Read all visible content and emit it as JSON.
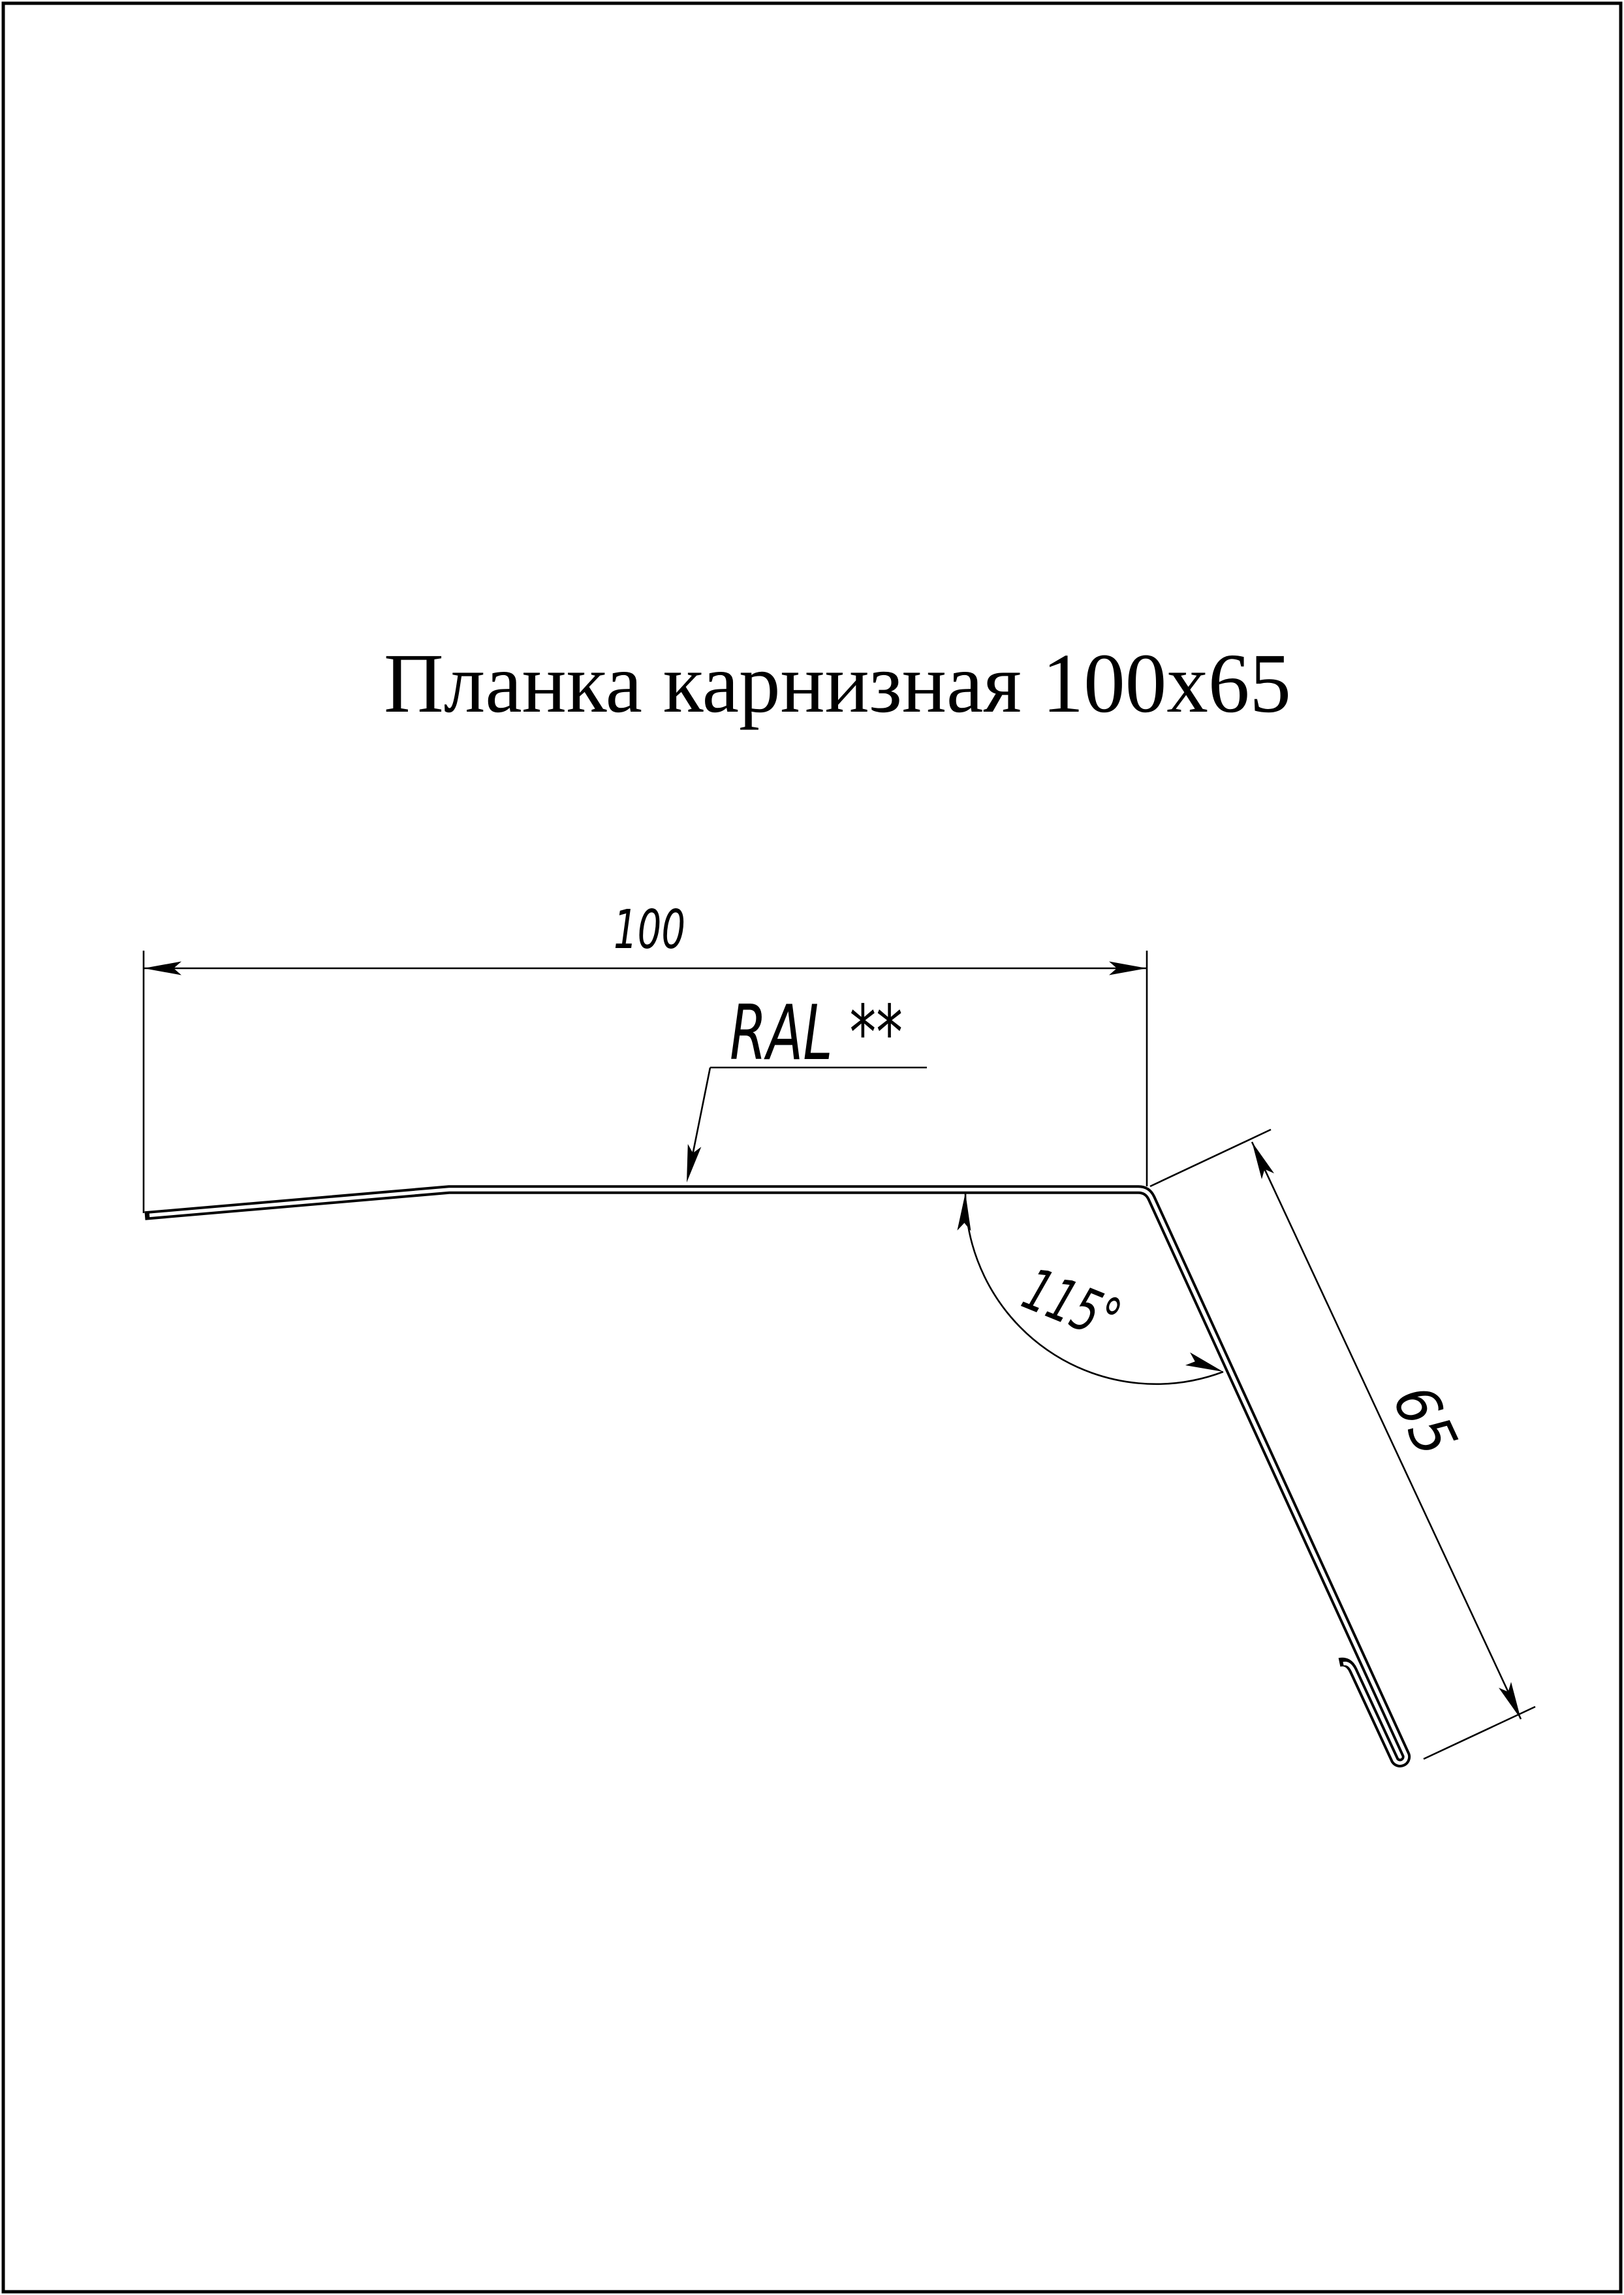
{
  "page": {
    "bg": "#ffffff",
    "line_color": "#000000"
  },
  "title": {
    "text": "Планка карнизная 100x65"
  },
  "dimensions": {
    "width": {
      "value": "100"
    },
    "height": {
      "value": "65"
    },
    "angle": {
      "value": "115°"
    }
  },
  "labels": {
    "color_note": "RAL **"
  }
}
